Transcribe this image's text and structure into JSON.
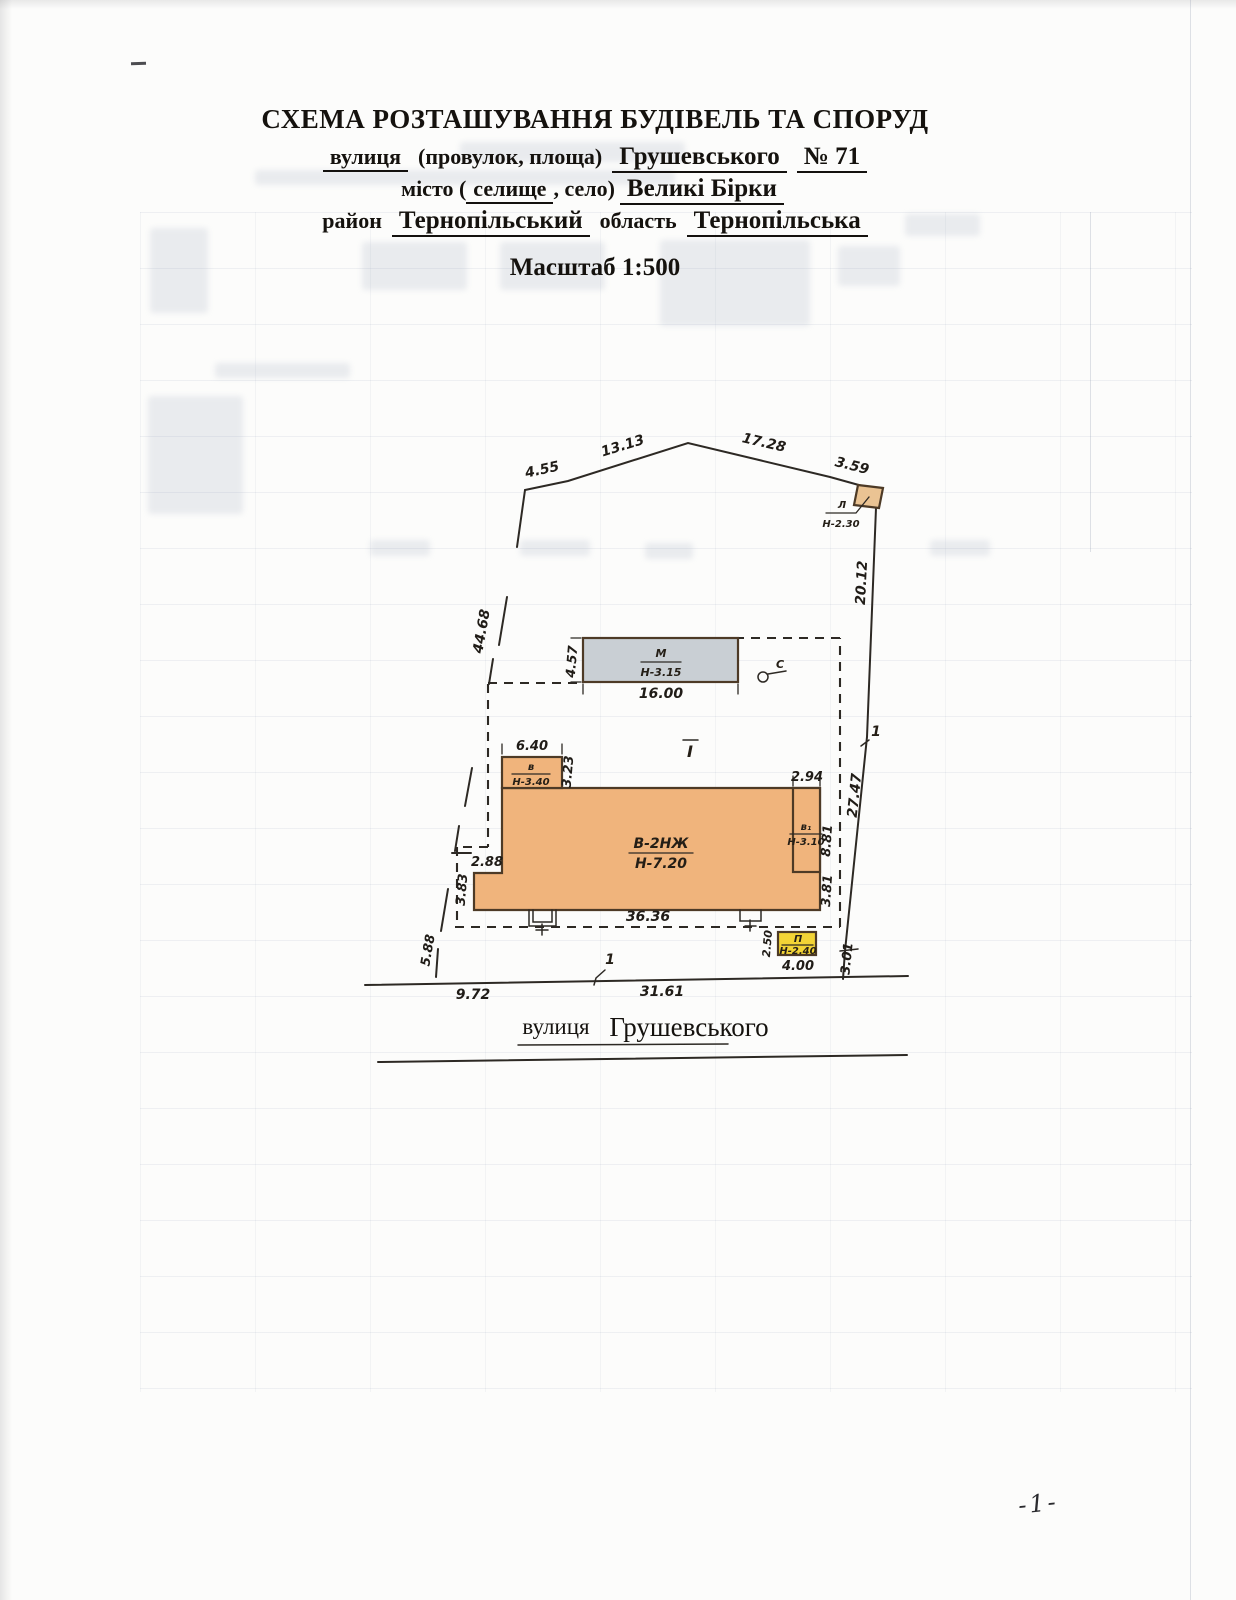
{
  "header": {
    "title": "СХЕМА РОЗТАШУВАННЯ БУДІВЕЛЬ ТА СПОРУД",
    "street_line": {
      "label": "вулиця",
      "paren": "(провулок, площа)",
      "value": "Грушевського",
      "number": "№ 71"
    },
    "city_line": {
      "label_pre": "місто (",
      "settlement": "селище",
      "label_post": ", село)",
      "value": "Великі  Бірки"
    },
    "district_line": {
      "label": "район",
      "district": "Тернопільський",
      "oblast_label": "область",
      "oblast": "Тернопільська"
    },
    "scale_label": "Масштаб 1:500"
  },
  "plan": {
    "dimensions": {
      "top_1": "4.55",
      "top_2": "13.13",
      "top_3": "17.28",
      "top_4": "3.59",
      "left_side": "44.68",
      "left_bottom": "5.88",
      "right_1": "20.12",
      "right_2": "27.47",
      "right_3": "3.01",
      "street_1": "9.72",
      "street_2": "31.61",
      "shed_m_width": "16.00",
      "shed_m_depth": "4.57",
      "annex_v_width": "6.40",
      "annex_v_depth": "3.23",
      "main_width": "36.36",
      "main_step": "2.88",
      "main_left": "3.83",
      "annex_v1_width": "2.94",
      "right_upper": "8.81",
      "right_lower": "3.81",
      "shed_p_width": "4.00",
      "shed_p_depth": "2.50"
    },
    "labels": {
      "main_name": "В-2НЖ",
      "main_height": "Н-7.20",
      "annex_v_name": "в",
      "annex_v_height": "Н-3.40",
      "annex_v1_name": "в₁",
      "annex_v1_height": "Н-3.10",
      "shed_m_name": "М",
      "shed_m_height": "Н-3.15",
      "shed_l_name": "Л",
      "shed_l_height": "Н-2.30",
      "shed_p_name": "П",
      "shed_p_height": "Н-2.40",
      "well_name": "С",
      "section": "І",
      "point_top": "1",
      "point_street": "1"
    },
    "street": {
      "label": "вулиця",
      "name": "Грушевського"
    }
  },
  "footer": {
    "page_number": "-1-"
  },
  "colors": {
    "building_main": "#F0B47C",
    "building_grey": "#C9CFD4",
    "building_yellow": "#F3D436",
    "shed_l_fill": "#EAC393"
  }
}
